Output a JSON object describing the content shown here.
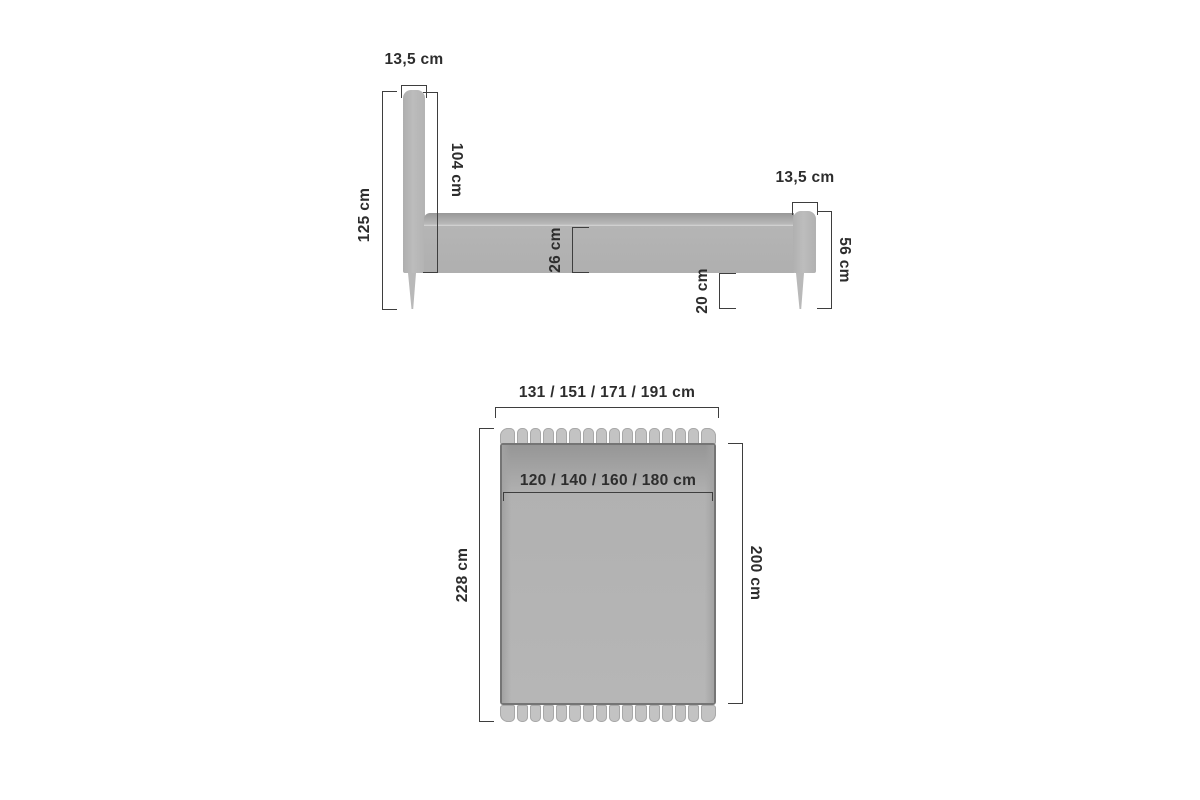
{
  "diagram_title": "bed-dimension-diagram",
  "side_view": {
    "headboard_thickness": "13,5 cm",
    "headboard_height": "125 cm",
    "headboard_above_base": "104 cm",
    "frame_height": "26 cm",
    "underbed_clearance": "20 cm",
    "footboard_thickness": "13,5 cm",
    "footboard_height": "56 cm"
  },
  "top_view": {
    "overall_width": "131 / 151 / 171 / 191 cm",
    "mattress_width": "120 / 140 / 160 / 180 cm",
    "overall_length": "228 cm",
    "mattress_length": "200 cm"
  },
  "colors": {
    "background": "#ffffff",
    "bed_fill": "#b4b4b4",
    "bed_fill_dark": "#9c9c9c",
    "tufting_fill": "#c3c3c3",
    "outline": "#757575",
    "dimension_line": "#3e3e3e",
    "text": "#2d2d2d"
  }
}
